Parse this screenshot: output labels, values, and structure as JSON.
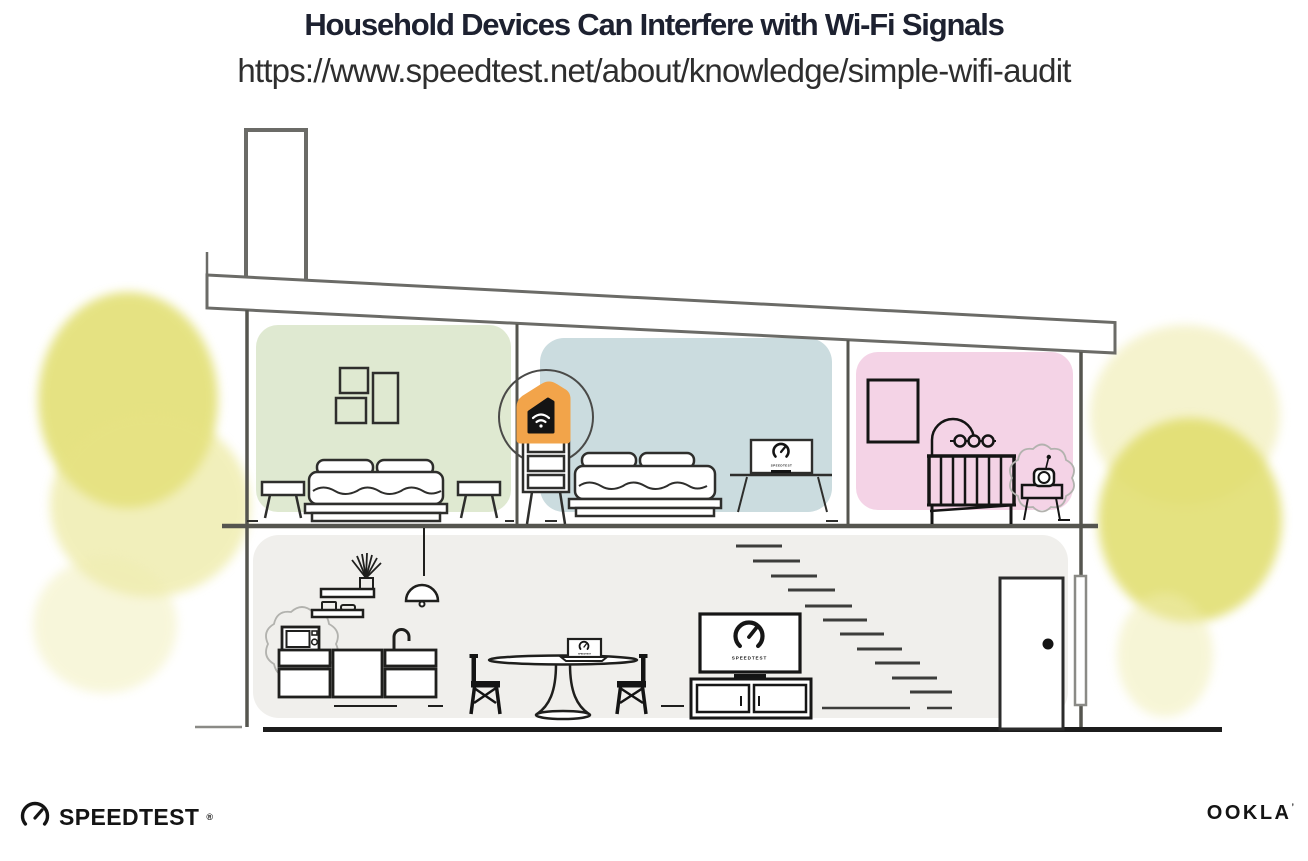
{
  "header": {
    "title": "Household Devices Can Interfere with Wi-Fi Signals",
    "url": "https://www.speedtest.net/about/knowledge/simple-wifi-audit"
  },
  "branding": {
    "speedtest_wordmark": "SPEEDTEST",
    "speedtest_reg_mark": "®",
    "ookla_wordmark": "OOKLA",
    "ookla_reg_mark": "’"
  },
  "illustration": {
    "screen_brand_label": "SPEEDTEST",
    "rooms": [
      {
        "name": "bedroom-green",
        "wall_color": "#dfe9d1"
      },
      {
        "name": "bedroom-blue",
        "wall_color": "#cbdcdf"
      },
      {
        "name": "nursery-pink",
        "wall_color": "#f4d3e6"
      },
      {
        "name": "ground-floor",
        "wall_color": "#f0efec"
      }
    ],
    "devices": [
      {
        "name": "wifi-router",
        "highlighted": true,
        "has_interference_scribble": false
      },
      {
        "name": "microwave-oven",
        "highlighted": false,
        "has_interference_scribble": true
      },
      {
        "name": "baby-monitor",
        "highlighted": false,
        "has_interference_scribble": true
      },
      {
        "name": "bedroom-monitor",
        "highlighted": false,
        "has_interference_scribble": false
      },
      {
        "name": "living-room-tv",
        "highlighted": false,
        "has_interference_scribble": false
      },
      {
        "name": "dining-table-laptop",
        "highlighted": false,
        "has_interference_scribble": false
      }
    ],
    "colors": {
      "accent_orange": "#f2a44a",
      "foliage_yellow": "#e1de6d",
      "line_gray": "#6b6b67",
      "ink": "#141414"
    }
  }
}
